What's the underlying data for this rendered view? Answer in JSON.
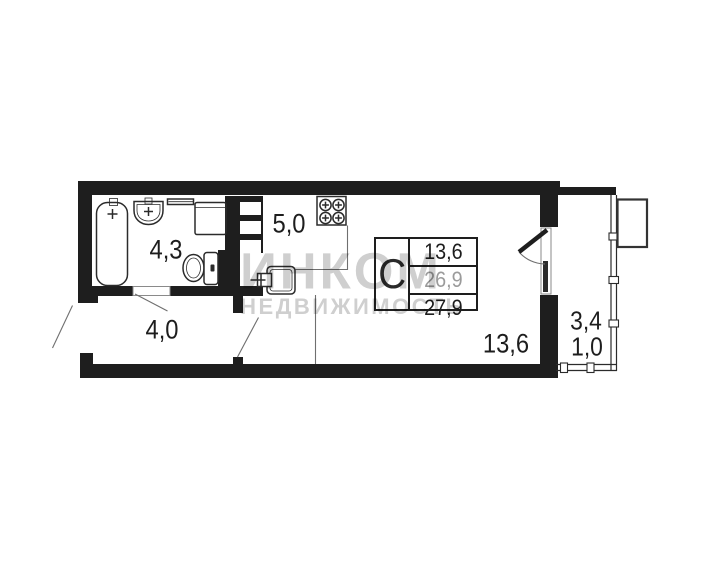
{
  "plan": {
    "rooms": {
      "bathroom": {
        "label": "4,3"
      },
      "kitchen": {
        "label": "5,0"
      },
      "hallway": {
        "label": "4,0"
      },
      "living_room": {
        "label": "13,6"
      },
      "balcony": {
        "label_top": "3,4",
        "label_bottom": "1,0"
      }
    },
    "info_table": {
      "unit_type": "С",
      "rows": [
        {
          "value": "13,6"
        },
        {
          "value": "26,9"
        },
        {
          "value": "27,9"
        }
      ]
    }
  },
  "watermark": {
    "line1": "ИНКОМ",
    "line2": "НЕДВИЖИМОСТЬ"
  },
  "colors": {
    "wall": "#1e1e1e",
    "fixture": "#2b2b2b",
    "thin": "#6f6f6f",
    "ink": "#1d1d1d",
    "muted_value": "#9b9b9b",
    "watermark": "#cfcfcf",
    "background": "#ffffff"
  }
}
